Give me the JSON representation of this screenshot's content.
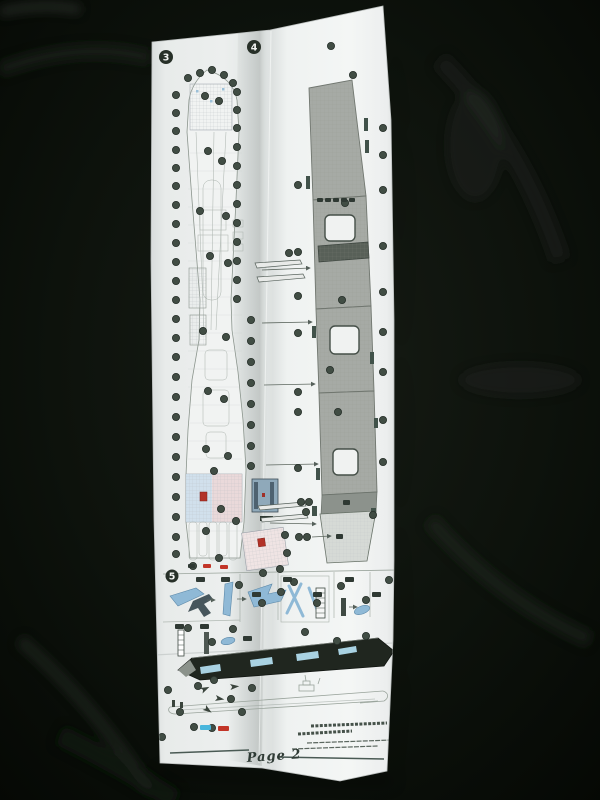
{
  "steps": {
    "three": "3",
    "four": "4",
    "five": "5"
  },
  "footer": {
    "page_label": "Page 2"
  },
  "colors": {
    "fabric": "#0b100b",
    "paper": "#eef0ef",
    "ink": "#3a443e",
    "deck_gray": "#a6aaa5",
    "deck_dark": "#586058",
    "plan_line": "#8a948c",
    "dot": "#414d44",
    "chip_dark": "#2f3933",
    "legend_red": "#c23528",
    "legend_blue": "#49b6dc",
    "part_blue": "#8fb9d6",
    "elevator_blue": "#a9d2e2",
    "deck_strip": "#20261f",
    "red_marker": "#b23228"
  },
  "figures": {
    "callout_dots": [
      [
        176,
        95
      ],
      [
        176,
        113
      ],
      [
        176,
        131
      ],
      [
        176,
        150
      ],
      [
        176,
        168
      ],
      [
        176,
        186
      ],
      [
        176,
        205
      ],
      [
        176,
        224
      ],
      [
        176,
        243
      ],
      [
        176,
        262
      ],
      [
        176,
        281
      ],
      [
        176,
        300
      ],
      [
        176,
        319
      ],
      [
        176,
        338
      ],
      [
        176,
        357
      ],
      [
        176,
        377
      ],
      [
        176,
        397
      ],
      [
        176,
        417
      ],
      [
        176,
        437
      ],
      [
        176,
        457
      ],
      [
        176,
        477
      ],
      [
        176,
        497
      ],
      [
        176,
        517
      ],
      [
        176,
        537
      ],
      [
        176,
        554
      ],
      [
        237,
        92
      ],
      [
        237,
        110
      ],
      [
        237,
        128
      ],
      [
        237,
        147
      ],
      [
        237,
        166
      ],
      [
        237,
        185
      ],
      [
        237,
        204
      ],
      [
        237,
        223
      ],
      [
        237,
        242
      ],
      [
        237,
        261
      ],
      [
        237,
        280
      ],
      [
        237,
        299
      ],
      [
        251,
        320
      ],
      [
        251,
        341
      ],
      [
        251,
        362
      ],
      [
        251,
        383
      ],
      [
        251,
        404
      ],
      [
        251,
        425
      ],
      [
        251,
        446
      ],
      [
        251,
        466
      ],
      [
        188,
        78
      ],
      [
        200,
        73
      ],
      [
        212,
        70
      ],
      [
        224,
        75
      ],
      [
        233,
        83
      ],
      [
        285,
        535
      ],
      [
        287,
        553
      ],
      [
        280,
        569
      ],
      [
        263,
        573
      ],
      [
        205,
        96
      ],
      [
        219,
        101
      ],
      [
        208,
        151
      ],
      [
        222,
        161
      ],
      [
        200,
        211
      ],
      [
        226,
        216
      ],
      [
        210,
        256
      ],
      [
        228,
        263
      ],
      [
        203,
        331
      ],
      [
        226,
        337
      ],
      [
        208,
        391
      ],
      [
        224,
        399
      ],
      [
        206,
        449
      ],
      [
        228,
        456
      ],
      [
        214,
        471
      ],
      [
        221,
        509
      ],
      [
        206,
        531
      ],
      [
        236,
        521
      ],
      [
        219,
        558
      ],
      [
        193,
        566
      ],
      [
        331,
        46
      ],
      [
        353,
        75
      ],
      [
        298,
        185
      ],
      [
        298,
        252
      ],
      [
        298,
        296
      ],
      [
        298,
        333
      ],
      [
        298,
        392
      ],
      [
        298,
        412
      ],
      [
        298,
        468
      ],
      [
        301,
        502
      ],
      [
        309,
        502
      ],
      [
        306,
        512
      ],
      [
        299,
        537
      ],
      [
        307,
        537
      ],
      [
        383,
        128
      ],
      [
        383,
        155
      ],
      [
        383,
        190
      ],
      [
        383,
        246
      ],
      [
        383,
        292
      ],
      [
        383,
        332
      ],
      [
        383,
        372
      ],
      [
        383,
        420
      ],
      [
        383,
        462
      ],
      [
        373,
        515
      ],
      [
        342,
        300
      ],
      [
        338,
        412
      ],
      [
        345,
        203
      ],
      [
        330,
        370
      ],
      [
        289,
        253
      ],
      [
        239,
        585
      ],
      [
        262,
        603
      ],
      [
        294,
        582
      ],
      [
        317,
        603
      ],
      [
        341,
        586
      ],
      [
        366,
        600
      ],
      [
        389,
        580
      ],
      [
        305,
        632
      ],
      [
        337,
        641
      ],
      [
        281,
        592
      ],
      [
        188,
        628
      ],
      [
        212,
        642
      ],
      [
        233,
        629
      ],
      [
        366,
        636
      ],
      [
        168,
        690
      ],
      [
        180,
        712
      ],
      [
        198,
        686
      ],
      [
        214,
        680
      ],
      [
        231,
        699
      ],
      [
        252,
        688
      ],
      [
        162,
        737
      ],
      [
        242,
        712
      ],
      [
        194,
        727
      ],
      [
        212,
        728
      ]
    ],
    "chips": [
      [
        196,
        577,
        9,
        5,
        "chip_dark"
      ],
      [
        221,
        577,
        9,
        5,
        "chip_dark"
      ],
      [
        252,
        592,
        9,
        5,
        "chip_dark"
      ],
      [
        283,
        577,
        9,
        5,
        "chip_dark"
      ],
      [
        313,
        592,
        9,
        5,
        "chip_dark"
      ],
      [
        345,
        577,
        9,
        5,
        "chip_dark"
      ],
      [
        372,
        592,
        9,
        5,
        "chip_dark"
      ],
      [
        175,
        624,
        9,
        5,
        "chip_dark"
      ],
      [
        200,
        624,
        9,
        5,
        "chip_dark"
      ],
      [
        243,
        636,
        9,
        5,
        "chip_dark"
      ],
      [
        203,
        564,
        8,
        4,
        "legend_red"
      ],
      [
        220,
        565,
        8,
        4,
        "legend_red"
      ],
      [
        188,
        564,
        7,
        4,
        "chip_dark"
      ],
      [
        317,
        198,
        6,
        4,
        "chip_dark"
      ],
      [
        325,
        198,
        6,
        4,
        "chip_dark"
      ],
      [
        333,
        198,
        6,
        4,
        "chip_dark"
      ],
      [
        341,
        198,
        6,
        4,
        "chip_dark"
      ],
      [
        349,
        198,
        6,
        4,
        "chip_dark"
      ],
      [
        200,
        725,
        11,
        5,
        "legend_blue"
      ],
      [
        218,
        726,
        11,
        5,
        "legend_red"
      ],
      [
        336,
        534,
        7,
        5,
        "chip_dark"
      ],
      [
        343,
        500,
        7,
        5,
        "chip_dark"
      ]
    ]
  }
}
